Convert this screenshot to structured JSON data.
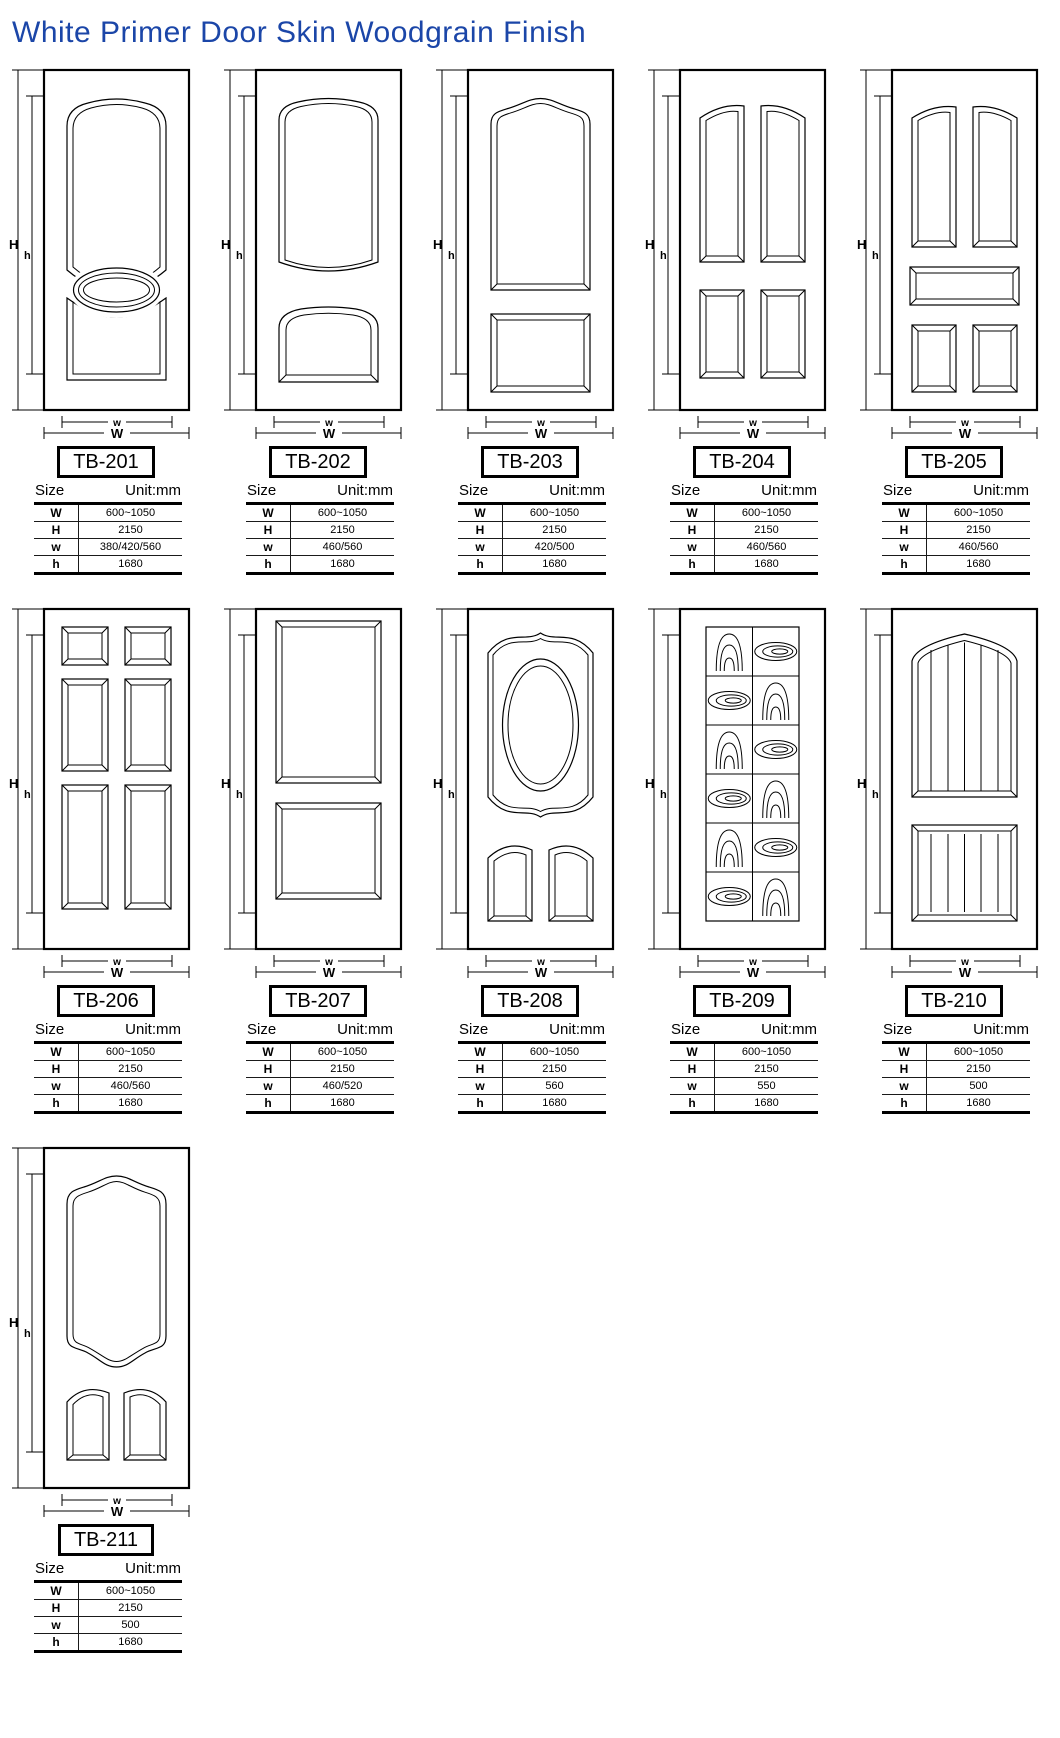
{
  "title": "White Primer Door Skin Woodgrain Finish",
  "accent_color": "#1b46a8",
  "dim_labels": {
    "H": "H",
    "h": "h",
    "W": "W",
    "w": "w"
  },
  "spec_header": {
    "size": "Size",
    "unit": "Unit:mm"
  },
  "doors": [
    {
      "model": "TB-201",
      "design": "arch-top-panel-oval-center-arch-bottom-panel",
      "specs": [
        {
          "label": "W",
          "value": "600~1050"
        },
        {
          "label": "H",
          "value": "2150"
        },
        {
          "label": "w",
          "value": "380/420/560"
        },
        {
          "label": "h",
          "value": "1680"
        }
      ]
    },
    {
      "model": "TB-202",
      "design": "arch-top-panel-arch-bottom-panel",
      "specs": [
        {
          "label": "W",
          "value": "600~1050"
        },
        {
          "label": "H",
          "value": "2150"
        },
        {
          "label": "w",
          "value": "460/560"
        },
        {
          "label": "h",
          "value": "1680"
        }
      ]
    },
    {
      "model": "TB-203",
      "design": "ogee-arch-top-panel-square-bottom-panel",
      "specs": [
        {
          "label": "W",
          "value": "600~1050"
        },
        {
          "label": "H",
          "value": "2150"
        },
        {
          "label": "w",
          "value": "420/500"
        },
        {
          "label": "h",
          "value": "1680"
        }
      ]
    },
    {
      "model": "TB-204",
      "design": "four-panel-cathedral-tops",
      "specs": [
        {
          "label": "W",
          "value": "600~1050"
        },
        {
          "label": "H",
          "value": "2150"
        },
        {
          "label": "w",
          "value": "460/560"
        },
        {
          "label": "h",
          "value": "1680"
        }
      ]
    },
    {
      "model": "TB-205",
      "design": "five-panel-cathedral-tops-center-rail",
      "specs": [
        {
          "label": "W",
          "value": "600~1050"
        },
        {
          "label": "H",
          "value": "2150"
        },
        {
          "label": "w",
          "value": "460/560"
        },
        {
          "label": "h",
          "value": "1680"
        }
      ]
    },
    {
      "model": "TB-206",
      "design": "six-panel-colonial",
      "specs": [
        {
          "label": "W",
          "value": "600~1050"
        },
        {
          "label": "H",
          "value": "2150"
        },
        {
          "label": "w",
          "value": "460/560"
        },
        {
          "label": "h",
          "value": "1680"
        }
      ]
    },
    {
      "model": "TB-207",
      "design": "two-rectangular-panels",
      "specs": [
        {
          "label": "W",
          "value": "600~1050"
        },
        {
          "label": "H",
          "value": "2150"
        },
        {
          "label": "w",
          "value": "460/520"
        },
        {
          "label": "h",
          "value": "1680"
        }
      ]
    },
    {
      "model": "TB-208",
      "design": "oval-in-scalloped-top-panel-two-arch-bottom-panels",
      "specs": [
        {
          "label": "W",
          "value": "600~1050"
        },
        {
          "label": "H",
          "value": "2150"
        },
        {
          "label": "w",
          "value": "560"
        },
        {
          "label": "h",
          "value": "1680"
        }
      ]
    },
    {
      "model": "TB-209",
      "design": "woodgrain-checkerboard-grid",
      "specs": [
        {
          "label": "W",
          "value": "600~1050"
        },
        {
          "label": "H",
          "value": "2150"
        },
        {
          "label": "w",
          "value": "550"
        },
        {
          "label": "h",
          "value": "1680"
        }
      ]
    },
    {
      "model": "TB-210",
      "design": "planked-arch-top-panel-planked-bottom-panel",
      "specs": [
        {
          "label": "W",
          "value": "600~1050"
        },
        {
          "label": "H",
          "value": "2150"
        },
        {
          "label": "w",
          "value": "500"
        },
        {
          "label": "h",
          "value": "1680"
        }
      ]
    },
    {
      "model": "TB-211",
      "design": "ogee-arch-top-panel-two-arch-bottom-panels",
      "specs": [
        {
          "label": "W",
          "value": "600~1050"
        },
        {
          "label": "H",
          "value": "2150"
        },
        {
          "label": "w",
          "value": "500"
        },
        {
          "label": "h",
          "value": "1680"
        }
      ]
    }
  ]
}
